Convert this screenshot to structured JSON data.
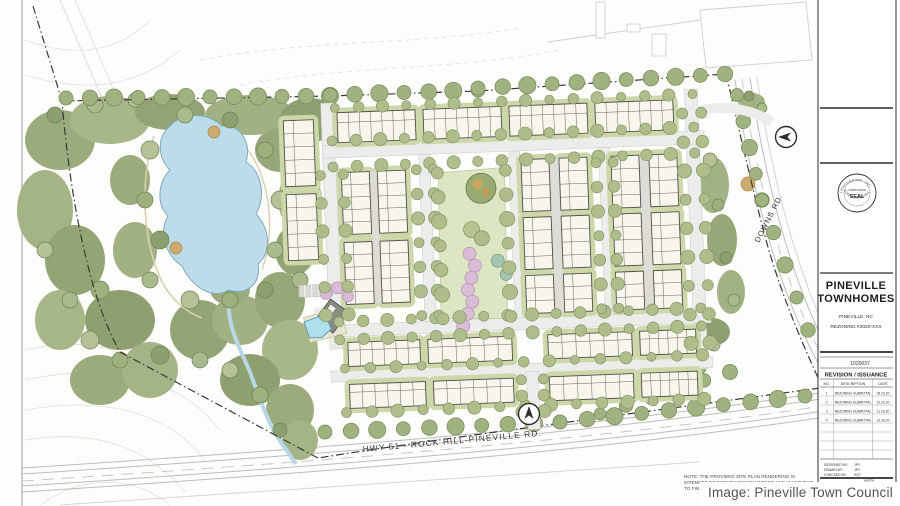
{
  "page": {
    "caption": "Image: Pineville Town Council"
  },
  "plan": {
    "labels": {
      "highway": "HWY 51 - ROCK HILL-PINEVILLE RD.",
      "downs_road": "DOWNS RD."
    },
    "note_lines": [
      "NOTE: THE PROVIDED SITE PLAN RENDERING IS",
      "INTENDED TO CONVEY DESIGN INTENT AND IS SUBJECT",
      "TO FINAL DESIGN"
    ]
  },
  "title_block": {
    "project_name_line1": "PINEVILLE",
    "project_name_line2": "TOWNHOMES",
    "location": "PINEVILLE, NC",
    "rezoning_ref": "REZONING #2020-XXX",
    "project_number": "1020037",
    "revision_table": {
      "header": "REVISION / ISSUANCE",
      "columns": {
        "no": "NO.",
        "description": "DESCRIPTION",
        "date": "DATE"
      },
      "rows": [
        {
          "no": "1",
          "description": "REZONING SUBMITTAL",
          "date": "09.23.20"
        },
        {
          "no": "2",
          "description": "REZONING SUBMITTAL",
          "date": "10.20.20"
        },
        {
          "no": "3",
          "description": "REZONING SUBMITTAL",
          "date": "11.18.20"
        },
        {
          "no": "4",
          "description": "REZONING SUBMITTAL",
          "date": "12.18.20"
        }
      ]
    },
    "credits": {
      "designed_by_label": "DESIGNED BY:",
      "designed_by": "JPY",
      "drawn_by_label": "DRAWN BY:",
      "drawn_by": "JPY",
      "checked_by_label": "CHECKED BY:",
      "checked_by": "KGT"
    },
    "seal": {
      "arc_top": "LANDDESIGN, INC.",
      "line1": "CORPORATE",
      "line2": "SEAL",
      "arc_bottom": "NORTH CAROLINA"
    },
    "north_label": "NORTH"
  },
  "colors": {
    "pond": "#bcdcea",
    "forest_base": "#a3b284",
    "park": "#dde6c2",
    "building": "#f8f6ec",
    "pink_tree": "#d9bcd6",
    "street": "#ececea",
    "pool": "#aee0ec",
    "boundary": "#3a3a35"
  }
}
